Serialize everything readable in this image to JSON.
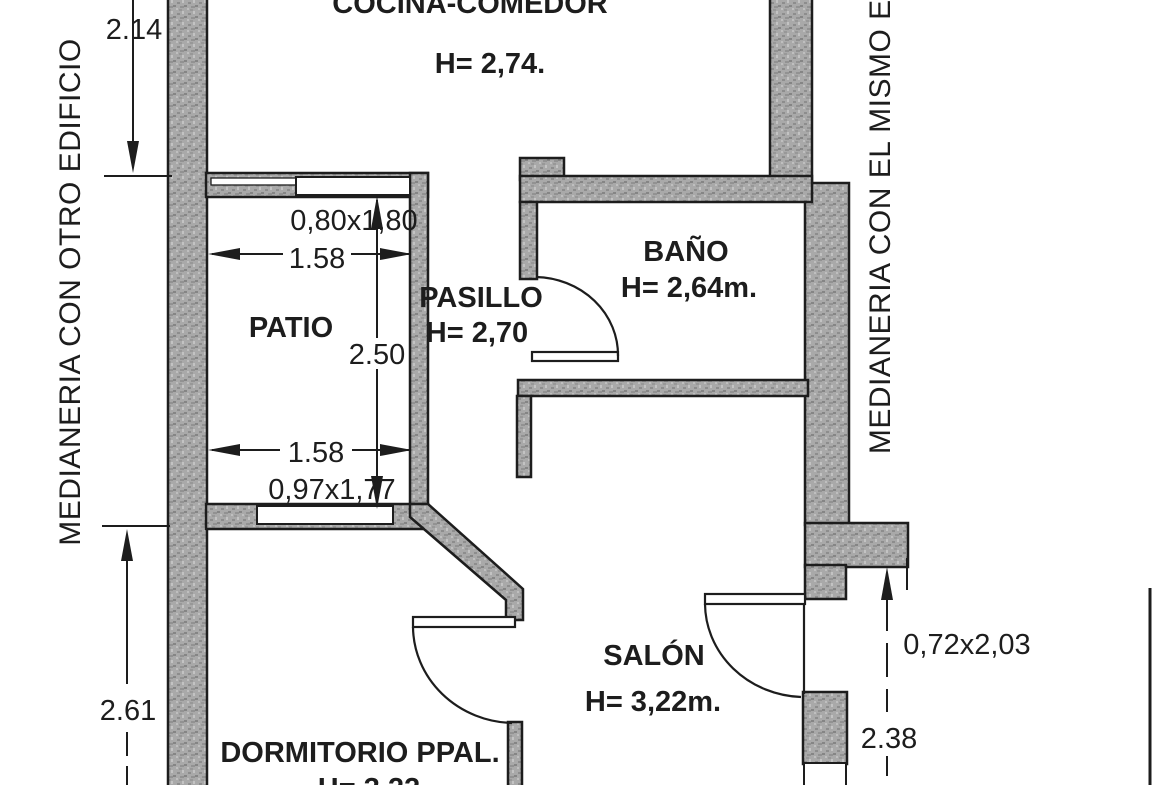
{
  "document": {
    "type": "scanned architectural floor plan"
  },
  "rooms": {
    "cocina": {
      "label": "COCINA-COMEDOR",
      "height": "H= 2,74."
    },
    "patio": {
      "label": "PATIO"
    },
    "pasillo": {
      "label": "PASILLO",
      "height": "H= 2,70"
    },
    "bano": {
      "label": "BAÑO",
      "height": "H= 2,64m."
    },
    "salon": {
      "label": "SALÓN",
      "height": "H= 3,22m."
    },
    "dormitorio": {
      "label": "DORMITORIO PPAL.",
      "height": "H= 3,22"
    }
  },
  "party_walls": {
    "left": "MEDIANERIA CON OTRO EDIFICIO",
    "right": "MEDIANERIA CON EL MISMO EDIFICIO"
  },
  "dimensions": {
    "left_top": "2.14",
    "left_bottom": "2.61",
    "patio_top_width": "1.58",
    "patio_bottom_width": "1.58",
    "patio_depth": "2.50",
    "window_top": "0,80x1,80",
    "window_bottom": "0,97x1,77",
    "right_opening": "0,72x2,03",
    "right_bottom": "2.38"
  },
  "colors": {
    "line": "#1d1d1d",
    "wall_fill": "#a9a9a9",
    "background": "#ffffff"
  }
}
